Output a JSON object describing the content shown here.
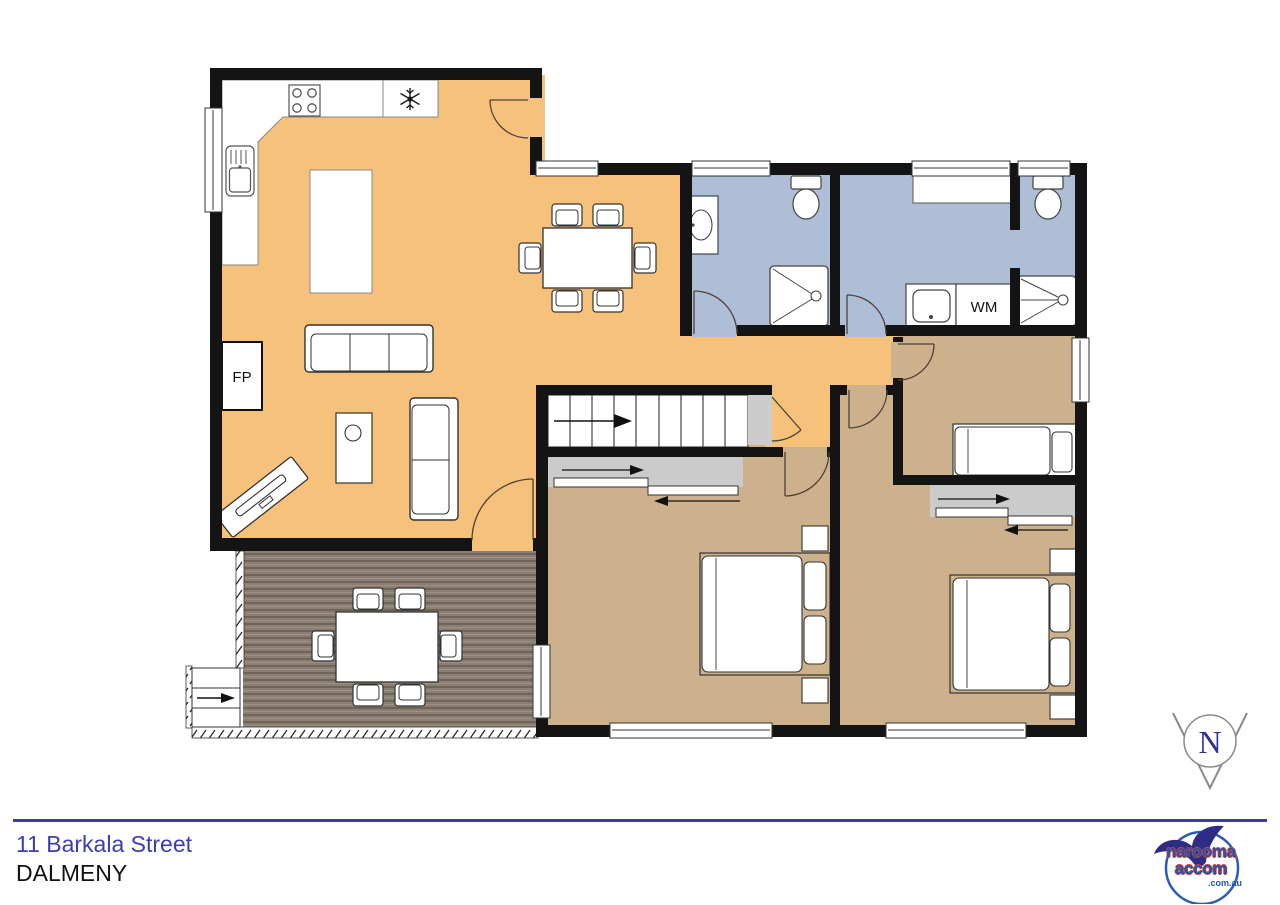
{
  "plan": {
    "labels": {
      "fireplace": "FP",
      "washing_machine": "WM"
    },
    "compass": {
      "north": "N"
    }
  },
  "footer": {
    "address_line1": "11 Barkala Street",
    "address_line2": "DALMENY",
    "logo": {
      "word1": "narooma",
      "word2": "accom",
      "word3": ".com.au"
    }
  },
  "colors": {
    "living_floor": "#F6C17B",
    "wet_area_floor": "#AEBED6",
    "bedroom_floor": "#CDB18C",
    "wardrobe_gray": "#CBCBCB",
    "landing_gray": "#CCCCCC",
    "deck_board": "#8B7F73",
    "wall_black": "#141414",
    "accent_blue": "#3A3AA8",
    "address_blue": "#3C3CB4",
    "logo_navy": "#2B2D87",
    "logo_blue": "#1F55B5",
    "logo_red": "#D8402F"
  }
}
